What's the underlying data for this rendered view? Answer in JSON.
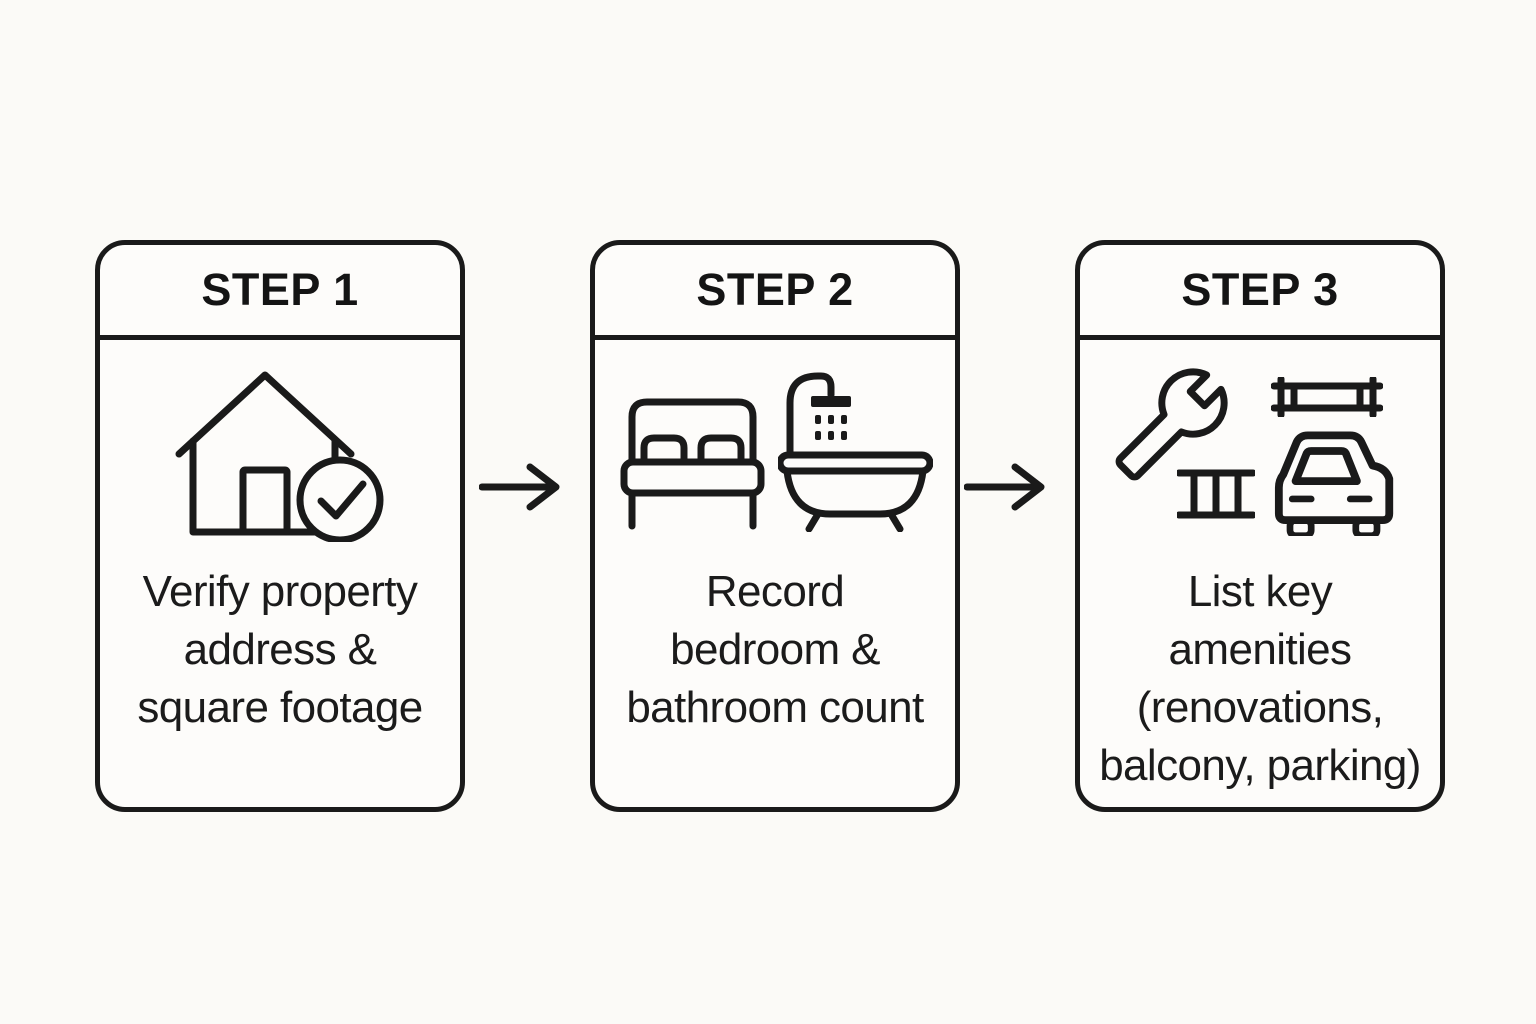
{
  "canvas": {
    "background_color": "#fbfaf7",
    "card_background_color": "#fdfcfa",
    "ink_color": "#1a1a1a"
  },
  "steps": [
    {
      "header": "STEP 1",
      "icons": [
        "house-icon",
        "check-circle-icon"
      ],
      "caption_lines": [
        "Verify property",
        "address &",
        "square footage"
      ]
    },
    {
      "header": "STEP 2",
      "icons": [
        "bed-icon",
        "shower-bathtub-icon"
      ],
      "caption_lines": [
        "Record",
        "bedroom &",
        "bathroom count"
      ]
    },
    {
      "header": "STEP 3",
      "icons": [
        "wrench-icon",
        "balcony-railing-icon",
        "scaffold-icon",
        "car-icon"
      ],
      "caption_lines": [
        "List key",
        "amenities",
        "(renovations,",
        "balcony, parking)"
      ]
    }
  ],
  "connectors": [
    {
      "glyph": "right-arrow"
    },
    {
      "glyph": "right-arrow"
    }
  ]
}
